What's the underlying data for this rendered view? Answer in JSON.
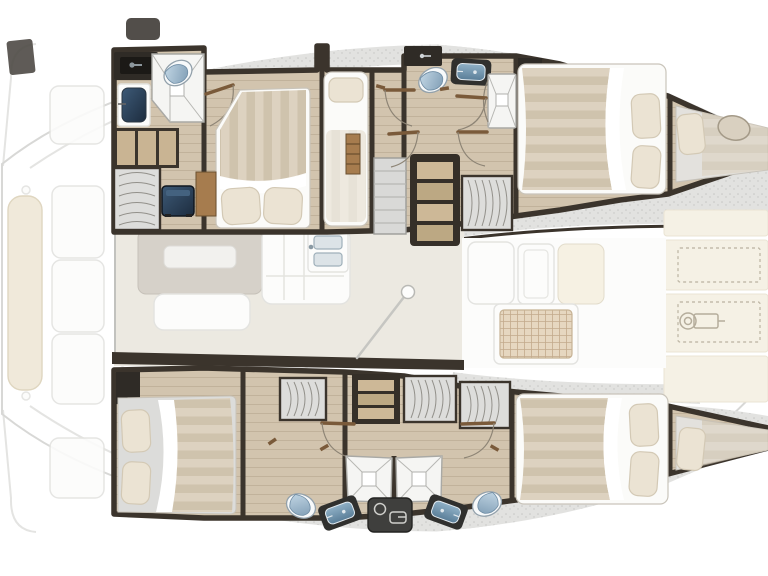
{
  "figure": {
    "kind": "catamaran-interior-floor-plan",
    "view": "top-down",
    "orientation": "bow-right-stern-left"
  },
  "inventory": {
    "double_cabins": 4,
    "single_berths": 1,
    "forepeak_berths": 2,
    "bathrooms": 4,
    "showers": 4,
    "toilets": 4,
    "washbasins": 4,
    "wardrobes": 5,
    "stair_units": 3,
    "bow_locker_panels": 4,
    "windlass": 1,
    "mast_step": 1,
    "salon_table": 1,
    "galley_sink": 1,
    "cockpit_seats": 5,
    "cockpit_bench": 1
  },
  "colors": {
    "wall": "#3b342c",
    "wall2": "#2f2b26",
    "wood": "#d2c4ae",
    "woodLine": "rgba(92,70,46,0.14)",
    "woodStep": "#c9b493",
    "woodAccent": "#a67c4e",
    "leaf": "#7a5a3a",
    "arc": "#8d8475",
    "speck": "#e2e2e0",
    "speckDot": "#c6c6c4",
    "stripeA": "#ddd2c0",
    "stripeB": "#cfc3ad",
    "pillow": "#ebe3d3",
    "pillowEdge": "#d3c9b5",
    "sheet": "#fbfbf9",
    "sheetEdge": "#c9c4ba",
    "grayBed": "#dcdcda",
    "tile": "#f5f5f3",
    "tileEdge": "#a9a9a5",
    "tileLine": "#b7b7b3",
    "toiletBody": "#f7f9fa",
    "toiletEdge": "#93a1ab",
    "lidA": "#c2d6e4",
    "lidB": "#7e9cb4",
    "counter": "#2f2b26",
    "basinA": "#8fb0c6",
    "basinB": "#5a7e98",
    "navyA": "#3d5a77",
    "navyB": "#1d2c3e",
    "salonFloor": "#ece9e1",
    "white": "#fcfcfb",
    "ghost": "#e3e3e0",
    "bench": "#efe7d6",
    "benchEdge": "#dcd2ba",
    "cream": "#f5f1e5",
    "creamEdge": "#eae4d4",
    "dash": "#c3bcab",
    "table": "#d6d1c9",
    "tableEdge": "#c6c1b9",
    "tray": "#f2f1ee",
    "grid": "#e6d7c0",
    "gridLine": "#c3aa8c",
    "console": "#3f3f3d",
    "wrBg": "#dddddb",
    "wrArc": "#92908a",
    "stair": "#d9d9d7",
    "outline": "#d8d8d6",
    "mast": "#c6c6c2",
    "glow": "#e09b4e",
    "fridgeLine": "#e3e3df",
    "windlass": "#b5ad9c",
    "basinShell": "#dce3e7",
    "basinShellEdge": "#9fb0ba"
  }
}
